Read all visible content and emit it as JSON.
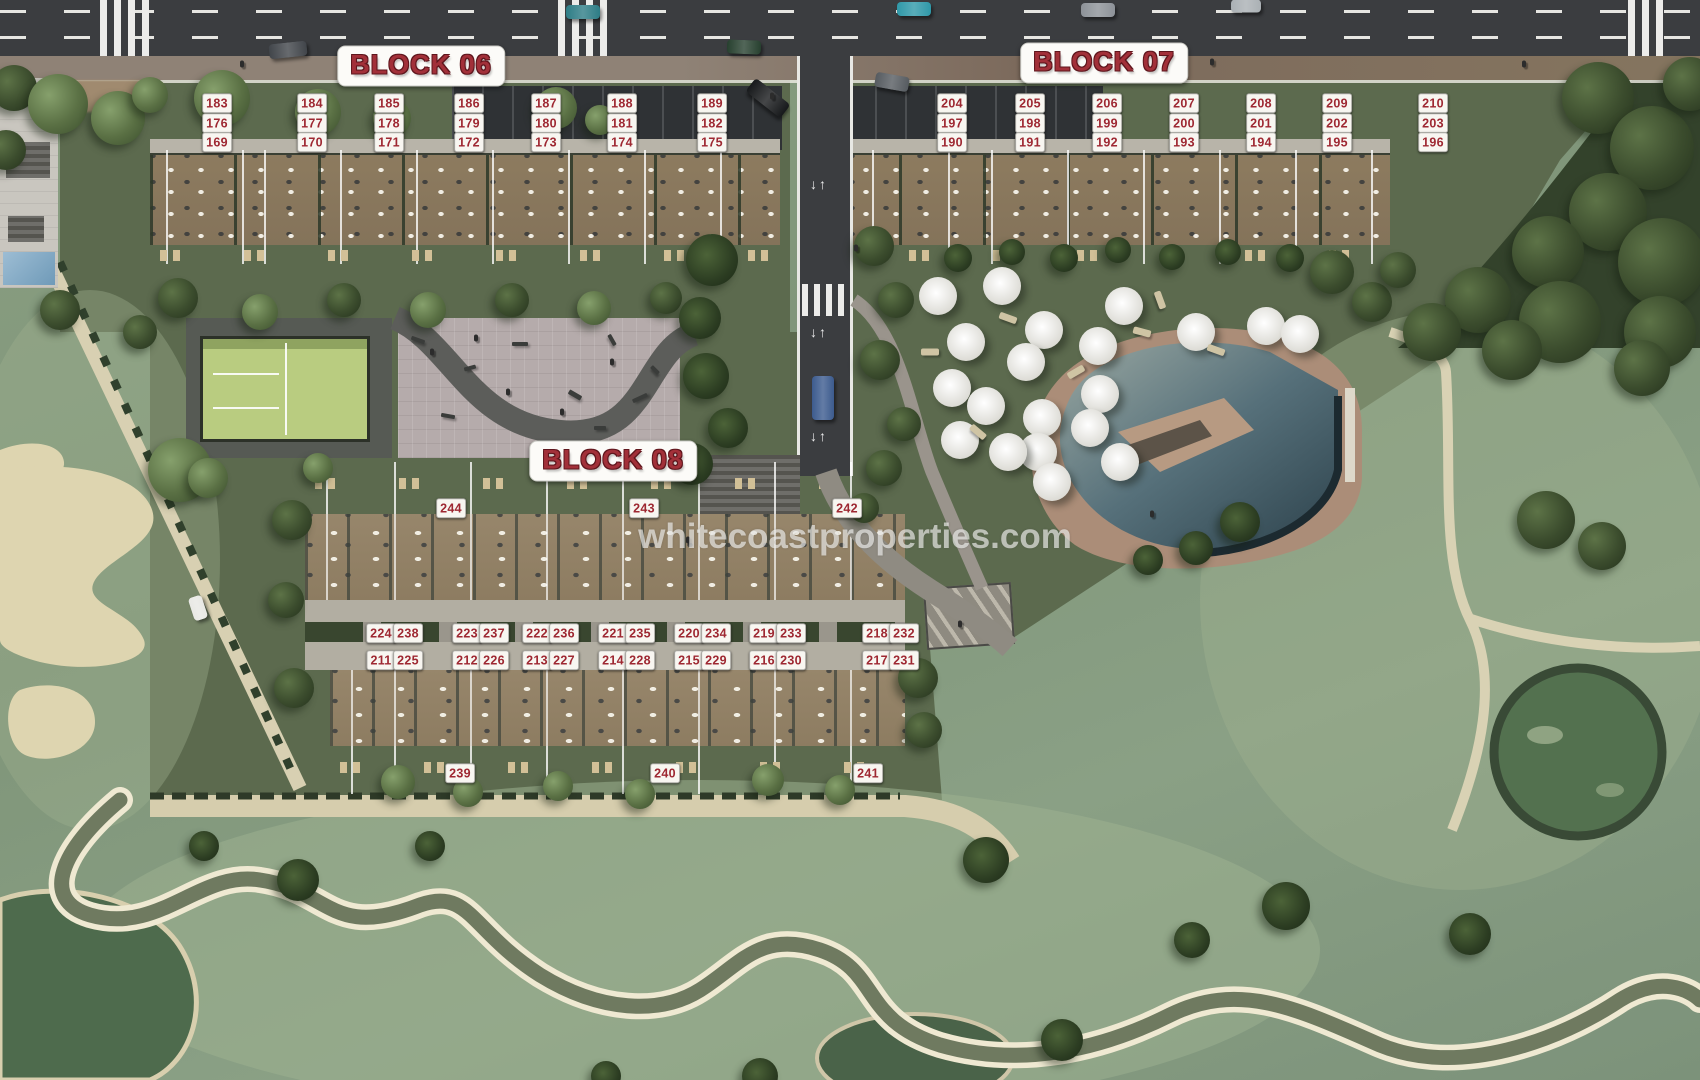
{
  "watermark": "whitecoastproperties.com",
  "marker_color": "#9e2832",
  "block_labels": [
    {
      "text": "BLOCK 06",
      "cx": 421,
      "cy": 66
    },
    {
      "text": "BLOCK 07",
      "cx": 1104,
      "cy": 63
    },
    {
      "text": "BLOCK 08",
      "cx": 613,
      "cy": 461
    }
  ],
  "unit_markers": {
    "block06": {
      "columns": [
        217,
        312,
        389,
        469,
        546,
        622,
        712
      ],
      "rows": [
        {
          "y": 103,
          "numbers": [
            183,
            184,
            185,
            186,
            187,
            188,
            189
          ]
        },
        {
          "y": 123,
          "numbers": [
            176,
            177,
            178,
            179,
            180,
            181,
            182
          ]
        },
        {
          "y": 142,
          "numbers": [
            169,
            170,
            171,
            172,
            173,
            174,
            175
          ]
        }
      ]
    },
    "block07": {
      "columns": [
        952,
        1030,
        1107,
        1184,
        1261,
        1337,
        1433
      ],
      "rows": [
        {
          "y": 103,
          "numbers": [
            204,
            205,
            206,
            207,
            208,
            209,
            210
          ]
        },
        {
          "y": 123,
          "numbers": [
            197,
            198,
            199,
            200,
            201,
            202,
            203
          ]
        },
        {
          "y": 142,
          "numbers": [
            190,
            191,
            192,
            193,
            194,
            195,
            196
          ]
        }
      ]
    },
    "block08_top": [
      {
        "n": 244,
        "x": 451,
        "y": 508
      },
      {
        "n": 243,
        "x": 644,
        "y": 508
      },
      {
        "n": 242,
        "x": 847,
        "y": 508
      }
    ],
    "block08_row1_y": 633,
    "block08_row1": [
      {
        "n": 224,
        "x": 381
      },
      {
        "n": 238,
        "x": 408
      },
      {
        "n": 223,
        "x": 467
      },
      {
        "n": 237,
        "x": 494
      },
      {
        "n": 222,
        "x": 537
      },
      {
        "n": 236,
        "x": 564
      },
      {
        "n": 221,
        "x": 613
      },
      {
        "n": 235,
        "x": 640
      },
      {
        "n": 220,
        "x": 689
      },
      {
        "n": 234,
        "x": 716
      },
      {
        "n": 219,
        "x": 764
      },
      {
        "n": 233,
        "x": 791
      },
      {
        "n": 218,
        "x": 877
      },
      {
        "n": 232,
        "x": 904
      }
    ],
    "block08_row2_y": 660,
    "block08_row2": [
      {
        "n": 211,
        "x": 381
      },
      {
        "n": 225,
        "x": 408
      },
      {
        "n": 212,
        "x": 467
      },
      {
        "n": 226,
        "x": 494
      },
      {
        "n": 213,
        "x": 537
      },
      {
        "n": 227,
        "x": 564
      },
      {
        "n": 214,
        "x": 613
      },
      {
        "n": 228,
        "x": 640
      },
      {
        "n": 215,
        "x": 689
      },
      {
        "n": 229,
        "x": 716
      },
      {
        "n": 216,
        "x": 764
      },
      {
        "n": 230,
        "x": 791
      },
      {
        "n": 217,
        "x": 877
      },
      {
        "n": 231,
        "x": 904
      }
    ],
    "block08_bottom": [
      {
        "n": 239,
        "x": 460,
        "y": 773
      },
      {
        "n": 240,
        "x": 665,
        "y": 773
      },
      {
        "n": 241,
        "x": 868,
        "y": 773
      }
    ]
  }
}
